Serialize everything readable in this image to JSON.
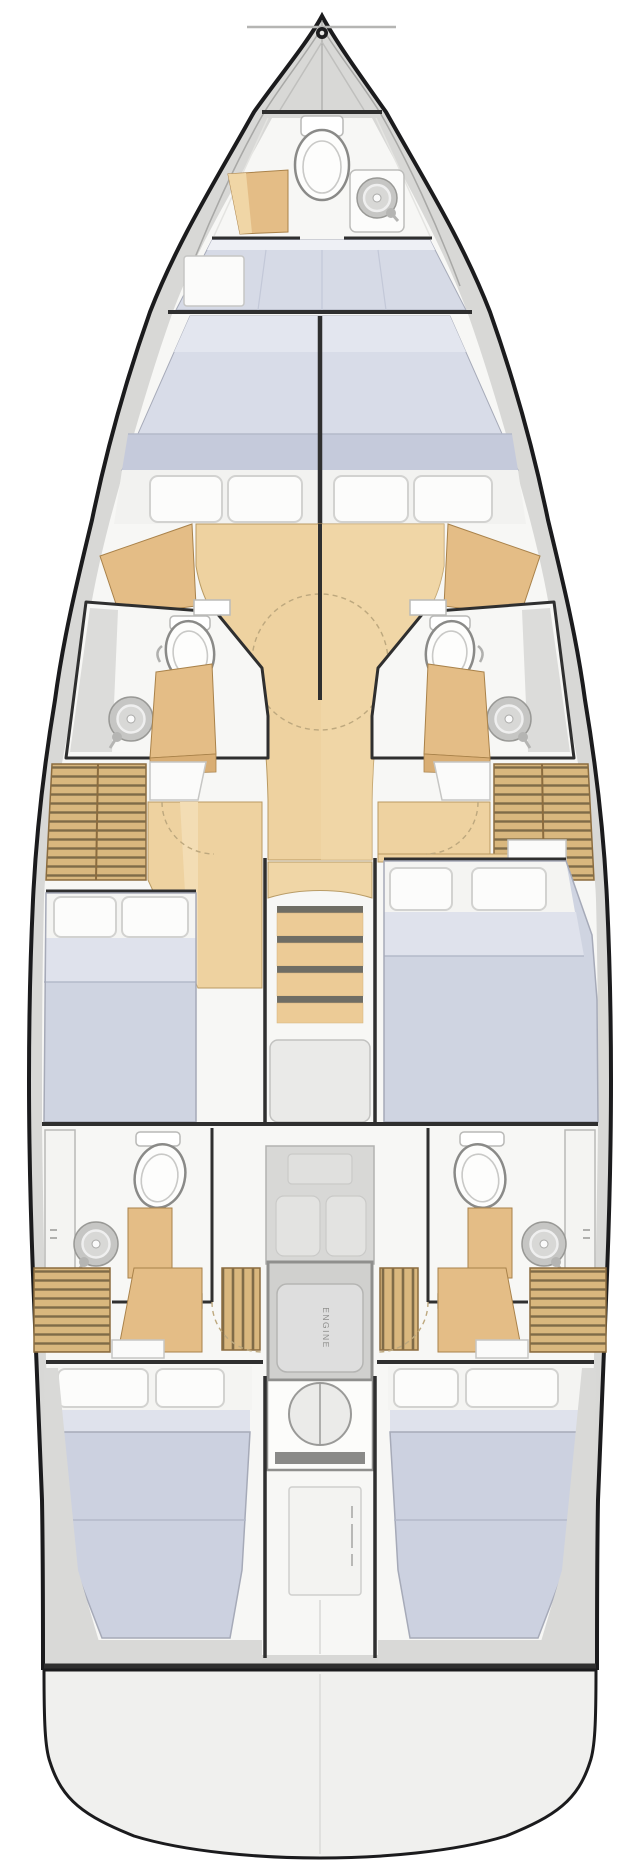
{
  "boat_plan": {
    "engine_label": "ENGINE",
    "colors": {
      "hull": "#1b1b1d",
      "deck": "#d8d8d6",
      "interior": "#f7f7f5",
      "wall": "#2f2f2f",
      "wood_floor": "#eed2a0",
      "wood_furniture": "#e4bd86",
      "wood_light": "#f0d6a6",
      "louver": "#d9b77e",
      "louver_line": "#7f6b48",
      "bed": "#cfd4e1",
      "bed_light": "#dfe2ec",
      "bed_dark": "#c5cadb",
      "pillow": "#fcfcfb",
      "fixture_gray": "#c6c6c4",
      "engine_box": "#d0d0ce",
      "platform": "#f0f0ee"
    },
    "icons": {
      "bow_fitting": "anchor-roller",
      "toilet": "toilet-icon",
      "sink": "sink-icon",
      "stairs": "companionway-stairs-icon",
      "engine_hatch": "engine-hatch-icon",
      "liferaft_locker": "locker-outline-icon"
    }
  }
}
